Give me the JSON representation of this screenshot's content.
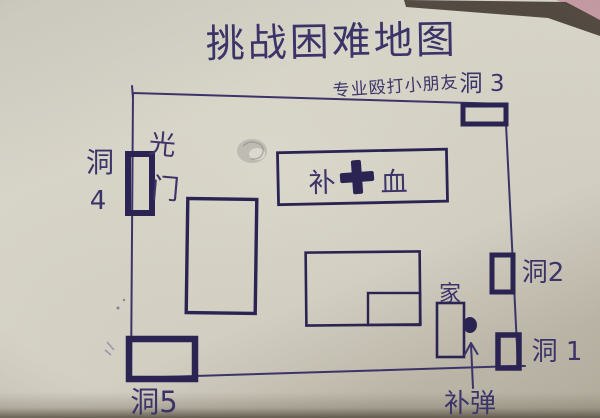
{
  "title": "挑战困难地图",
  "subtitle": "专业殴打小朋友",
  "labels": {
    "hole1": "洞 1",
    "hole2": "洞2",
    "hole3": "洞 3",
    "hole4_top": "洞",
    "hole4_bottom": "4",
    "hole5": "洞5",
    "light_top": "光",
    "light_bottom": "门",
    "home": "家",
    "health_left": "补",
    "health_right": "血",
    "ammo": "补弹"
  },
  "icons": {
    "health_cross": "plus-cross-icon",
    "ammo_arrow": "up-arrow-icon",
    "ammo_dot": "filled-dot"
  },
  "colors": {
    "ink": "#3c3468",
    "ink_bold": "#2b2452",
    "paper": "#d6d3c7",
    "paper_dark": "#bdb8aa",
    "edge_shadow": "#473e34",
    "table_pink": "#c69aa4"
  }
}
